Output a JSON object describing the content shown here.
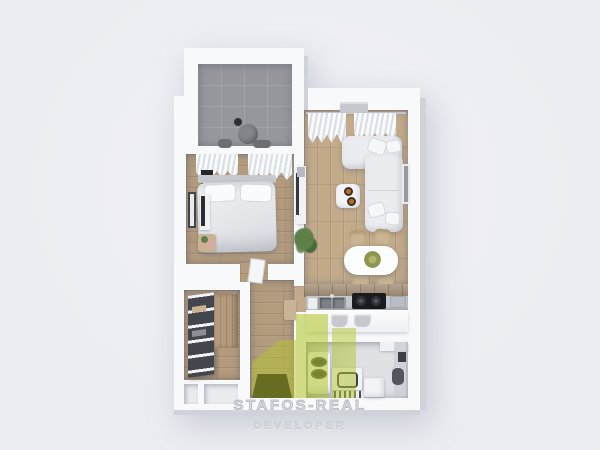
{
  "watermark": {
    "brand": "STAFOS-REAL",
    "subtitle": "DEVELOPER"
  },
  "palette": {
    "bg": "#ecedf2",
    "wall": "#f8f9fb",
    "wall_face": "#cfd2d9",
    "wood_living": "#c2aa8b",
    "wood_bedroom": "#b39b7e",
    "balcony_tile": "#96979c",
    "bath_floor": "#dfe1e5",
    "counter": "#c6c8cc",
    "cooktop": "#1a1b1f",
    "sofa": "#ebecef",
    "logo_green": "#b5c62e",
    "plant_green": "#5d7f49",
    "entry_dark": "#141519"
  }
}
